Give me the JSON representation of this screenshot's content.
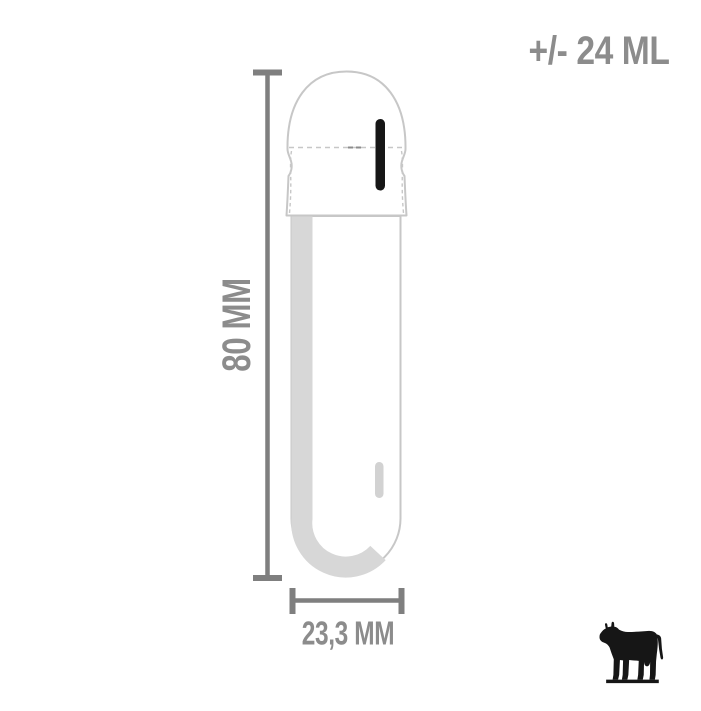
{
  "labels": {
    "volume": "+/- 24 ML",
    "height": "80 MM",
    "diameter": "23,3 MM"
  },
  "icons": {
    "animal": "cow"
  },
  "colors": {
    "background": "#ffffff",
    "text_gray": "#8c8c8c",
    "dimension_gray": "#7f7f7f",
    "outline_gray": "#c7c7c7",
    "shade_gray": "#d7d7d7",
    "highlight_gray": "#d2d2d2",
    "ink_black": "#161616"
  }
}
